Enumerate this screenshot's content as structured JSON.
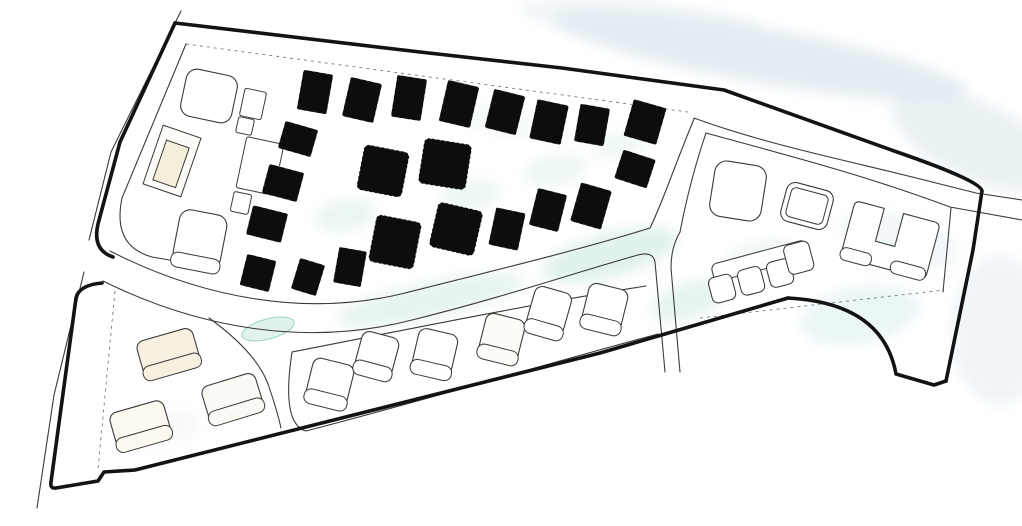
{
  "canvas": {
    "w": 1022,
    "h": 526,
    "bg": "#ffffff"
  },
  "palette": {
    "boundary": "#131313",
    "road": "#3a3a3a",
    "dashed": "#7a7a7a",
    "building_dark": "#0d0d0d",
    "building_light_stroke": "#3a3a3a",
    "cream": "#f5eedb",
    "mint": "#cdeade",
    "blue_wash": "#dce8ee"
  },
  "washes": [
    {
      "x": 760,
      "y": 55,
      "rx": 210,
      "ry": 28,
      "rot": 10,
      "color": "#dce8ee",
      "o": 0.75
    },
    {
      "x": 640,
      "y": 20,
      "rx": 120,
      "ry": 18,
      "rot": 5,
      "color": "#e4eef3",
      "o": 0.55
    },
    {
      "x": 975,
      "y": 140,
      "rx": 90,
      "ry": 38,
      "rot": 25,
      "color": "#dce8ee",
      "o": 0.6
    },
    {
      "x": 1000,
      "y": 330,
      "rx": 48,
      "ry": 75,
      "rot": 0,
      "color": "#e2edf2",
      "o": 0.55
    },
    {
      "x": 900,
      "y": 240,
      "rx": 60,
      "ry": 25,
      "rot": 15,
      "color": "#e0ecf1",
      "o": 0.4
    },
    {
      "x": 860,
      "y": 315,
      "rx": 60,
      "ry": 28,
      "rot": -10,
      "color": "#d5ecf0",
      "o": 0.5
    },
    {
      "x": 430,
      "y": 300,
      "rx": 95,
      "ry": 18,
      "rot": -12,
      "color": "#cdeade",
      "o": 0.5
    },
    {
      "x": 610,
      "y": 255,
      "rx": 70,
      "ry": 22,
      "rot": -15,
      "color": "#c9e8dc",
      "o": 0.55
    },
    {
      "x": 690,
      "y": 300,
      "rx": 40,
      "ry": 18,
      "rot": -20,
      "color": "#cdeade",
      "o": 0.5
    },
    {
      "x": 345,
      "y": 215,
      "rx": 30,
      "ry": 16,
      "rot": -10,
      "color": "#d5ede3",
      "o": 0.5
    },
    {
      "x": 470,
      "y": 195,
      "rx": 30,
      "ry": 15,
      "rot": -10,
      "color": "#d5ede3",
      "o": 0.45
    },
    {
      "x": 555,
      "y": 170,
      "rx": 32,
      "ry": 15,
      "rot": -10,
      "color": "#d8efe5",
      "o": 0.45
    },
    {
      "x": 620,
      "y": 145,
      "rx": 26,
      "ry": 13,
      "rot": -10,
      "color": "#d8efe5",
      "o": 0.4
    },
    {
      "x": 760,
      "y": 255,
      "rx": 35,
      "ry": 14,
      "rot": -12,
      "color": "#d5ede3",
      "o": 0.4
    },
    {
      "x": 500,
      "y": 122,
      "rx": 40,
      "ry": 14,
      "rot": 12,
      "color": "#e8f3ec",
      "o": 0.4
    },
    {
      "x": 160,
      "y": 430,
      "rx": 42,
      "ry": 18,
      "rot": -15,
      "color": "#eef4ee",
      "o": 0.4
    },
    {
      "x": 268,
      "y": 329,
      "rx": 27,
      "ry": 10,
      "rot": -15,
      "color": "#ddf2ea",
      "o": 0.85,
      "stroke": "#86ccb4"
    }
  ],
  "boundary": {
    "width": 3.6,
    "paths": [
      "M 175,23 L 420,52 L 562,68 L 724,90 L 897,152 Q 981,181 982,191 L 973,250 L 946,381",
      "M 946,381 L 934,385 L 896,374 Q 883,303 788,298",
      "M 788,298 L 600,353 L 135,470 L 104,472 L 98,481 L 56,488 Q 50,489 51,482 L 76,298 Q 79,285 102,283",
      "M 175,23 L 120,142 L 98,224 Q 92,250 113,257"
    ]
  },
  "roads": {
    "width": 1.1,
    "paths": [
      "M 181,11 L 111,152 L 89,240",
      "M 84,272 L 54,395 L 37,508",
      "M 110,251 C 200,297 305,318 405,293 C 505,268 590,247 650,228 C 662,204 676,162 694,119",
      "M 103,281 C 200,329 308,347 412,320 C 505,297 580,271 638,255 Q 653,251 655,262 L 665,372",
      "M 680,372 L 671,268 Q 671,247 680,232 Q 690,180 706,133",
      "M 694,118 C 770,146 860,163 940,184 Q 968,191 976,193 L 1022,200",
      "M 706,133 C 775,152 862,174 950,207 L 1022,220",
      "M 951,208 L 943,292",
      "M 292,352 C 400,331 520,306 646,286",
      "M 292,352 Q 281,424 306,431 C 430,399 545,364 658,334",
      "M 186,44 L 122,198 Q 112,246 152,257 L 210,267",
      "M 209,318 Q 256,352 268,384 Q 277,410 281,428"
    ]
  },
  "dashed": {
    "width": 0.9,
    "dash": "3 4",
    "paths": [
      "M 186,44 L 688,112",
      "M 115,291 L 98,469",
      "M 700,318 L 944,290"
    ]
  },
  "buildings_dark": {
    "items": [
      {
        "x": 315,
        "y": 92,
        "w": 30,
        "h": 40,
        "r": 10,
        "dash": false
      },
      {
        "x": 362,
        "y": 100,
        "w": 32,
        "h": 40,
        "r": 13,
        "dash": false
      },
      {
        "x": 409,
        "y": 98,
        "w": 30,
        "h": 42,
        "r": 9,
        "dash": false
      },
      {
        "x": 459,
        "y": 104,
        "w": 32,
        "h": 42,
        "r": 13,
        "dash": false
      },
      {
        "x": 505,
        "y": 112,
        "w": 32,
        "h": 40,
        "r": 14,
        "dash": false
      },
      {
        "x": 549,
        "y": 122,
        "w": 32,
        "h": 40,
        "r": 12,
        "dash": false
      },
      {
        "x": 592,
        "y": 125,
        "w": 30,
        "h": 38,
        "r": 10,
        "dash": false
      },
      {
        "x": 645,
        "y": 122,
        "w": 34,
        "h": 38,
        "r": 16,
        "dash": false
      },
      {
        "x": 635,
        "y": 169,
        "w": 34,
        "h": 30,
        "r": 18,
        "dash": false
      },
      {
        "x": 298,
        "y": 139,
        "w": 34,
        "h": 28,
        "r": 16,
        "dash": false
      },
      {
        "x": 283,
        "y": 183,
        "w": 36,
        "h": 30,
        "r": 15,
        "dash": false
      },
      {
        "x": 267,
        "y": 224,
        "w": 36,
        "h": 30,
        "r": 14,
        "dash": false
      },
      {
        "x": 258,
        "y": 273,
        "w": 30,
        "h": 32,
        "r": 14,
        "dash": false
      },
      {
        "x": 308,
        "y": 277,
        "w": 26,
        "h": 32,
        "r": 17,
        "dash": false
      },
      {
        "x": 350,
        "y": 267,
        "w": 28,
        "h": 36,
        "r": 10,
        "dash": false
      },
      {
        "x": 383,
        "y": 171,
        "w": 46,
        "h": 46,
        "r": 11,
        "dash": true
      },
      {
        "x": 445,
        "y": 164,
        "w": 48,
        "h": 46,
        "r": 9,
        "dash": true
      },
      {
        "x": 395,
        "y": 242,
        "w": 46,
        "h": 48,
        "r": 11,
        "dash": true
      },
      {
        "x": 456,
        "y": 229,
        "w": 46,
        "h": 46,
        "r": 13,
        "dash": true
      },
      {
        "x": 507,
        "y": 229,
        "w": 30,
        "h": 38,
        "r": 12,
        "dash": false
      },
      {
        "x": 548,
        "y": 210,
        "w": 30,
        "h": 38,
        "r": 14,
        "dash": false
      },
      {
        "x": 591,
        "y": 206,
        "w": 32,
        "h": 40,
        "r": 16,
        "dash": false
      }
    ]
  },
  "buildings_light": {
    "items": [
      {
        "x": 168,
        "y": 352,
        "w": 58,
        "h": 36,
        "r": -16,
        "fill": "#f7f0e0",
        "lip": true,
        "rx": 8
      },
      {
        "x": 232,
        "y": 397,
        "w": 56,
        "h": 36,
        "r": -17,
        "fill": "#fcfaf4",
        "lip": true,
        "rx": 8
      },
      {
        "x": 140,
        "y": 424,
        "w": 56,
        "h": 36,
        "r": -16,
        "fill": "#fcf9f1",
        "lip": true,
        "rx": 8
      },
      {
        "x": 330,
        "y": 382,
        "w": 42,
        "h": 42,
        "r": 14,
        "fill": "#ffffff",
        "lip": true,
        "rx": 8
      },
      {
        "x": 377,
        "y": 354,
        "w": 38,
        "h": 40,
        "r": 15,
        "fill": "#ffffff",
        "lip": true,
        "rx": 8
      },
      {
        "x": 435,
        "y": 352,
        "w": 40,
        "h": 42,
        "r": 13,
        "fill": "#ffffff",
        "lip": true,
        "rx": 8
      },
      {
        "x": 502,
        "y": 337,
        "w": 40,
        "h": 42,
        "r": 14,
        "fill": "#fefcf8",
        "lip": true,
        "rx": 8
      },
      {
        "x": 549,
        "y": 311,
        "w": 38,
        "h": 44,
        "r": 16,
        "fill": "#ffffff",
        "lip": true,
        "rx": 8
      },
      {
        "x": 605,
        "y": 307,
        "w": 40,
        "h": 42,
        "r": 14,
        "fill": "#ffffff",
        "lip": true,
        "rx": 8
      },
      {
        "x": 738,
        "y": 191,
        "w": 52,
        "h": 56,
        "r": 9,
        "fill": "#ffffff",
        "lip": false,
        "rx": 12
      },
      {
        "x": 807,
        "y": 206,
        "w": 48,
        "h": 40,
        "r": 15,
        "fill": "#ffffff",
        "lip": false,
        "rx": 9,
        "inner": true
      },
      {
        "x": 209,
        "y": 96,
        "w": 52,
        "h": 48,
        "r": 12,
        "fill": "#ffffff",
        "lip": false,
        "rx": 11
      },
      {
        "x": 200,
        "y": 239,
        "w": 48,
        "h": 54,
        "r": 11,
        "fill": "#ffffff",
        "lip": true,
        "rx": 11
      }
    ]
  },
  "amenity": {
    "blocks": [
      {
        "x": 253,
        "y": 104,
        "w": 22,
        "h": 28,
        "r": 12
      },
      {
        "x": 245,
        "y": 126,
        "w": 16,
        "h": 16,
        "r": 12
      },
      {
        "x": 260,
        "y": 166,
        "w": 38,
        "h": 52,
        "r": 12
      },
      {
        "x": 241,
        "y": 203,
        "w": 18,
        "h": 20,
        "r": 12
      }
    ],
    "pool": {
      "x": 172,
      "y": 161,
      "rot": 19,
      "outer_w": 40,
      "outer_h": 62,
      "inner_w": 24,
      "inner_h": 42,
      "inner_fill": "#f5eedb"
    }
  },
  "special": {
    "u_building": {
      "x": 890,
      "y": 241,
      "rot": 15,
      "path": "M -44,-24 Q -44,-30 -38,-30 L -14,-30 L -14,4 L 6,4 L 6,-30 L 38,-30 Q 44,-30 44,-24 L 44,22 Q 44,28 38,28 L -38,28 Q -44,28 -44,22 Z",
      "lips": [
        {
          "x": -29,
          "y": 24,
          "w": 32,
          "h": 13
        },
        {
          "x": 25,
          "y": 24,
          "w": 36,
          "h": 13
        }
      ]
    },
    "comb": {
      "x": 757,
      "y": 272,
      "rot": -15,
      "parts": [
        {
          "x": 6,
          "y": -10,
          "w": 98,
          "h": 18
        },
        {
          "x": -38,
          "y": 7,
          "w": 24,
          "h": 26
        },
        {
          "x": -8,
          "y": 7,
          "w": 24,
          "h": 26
        },
        {
          "x": 22,
          "y": 7,
          "w": 24,
          "h": 26
        },
        {
          "x": 44,
          "y": -3,
          "w": 26,
          "h": 30
        }
      ]
    }
  }
}
